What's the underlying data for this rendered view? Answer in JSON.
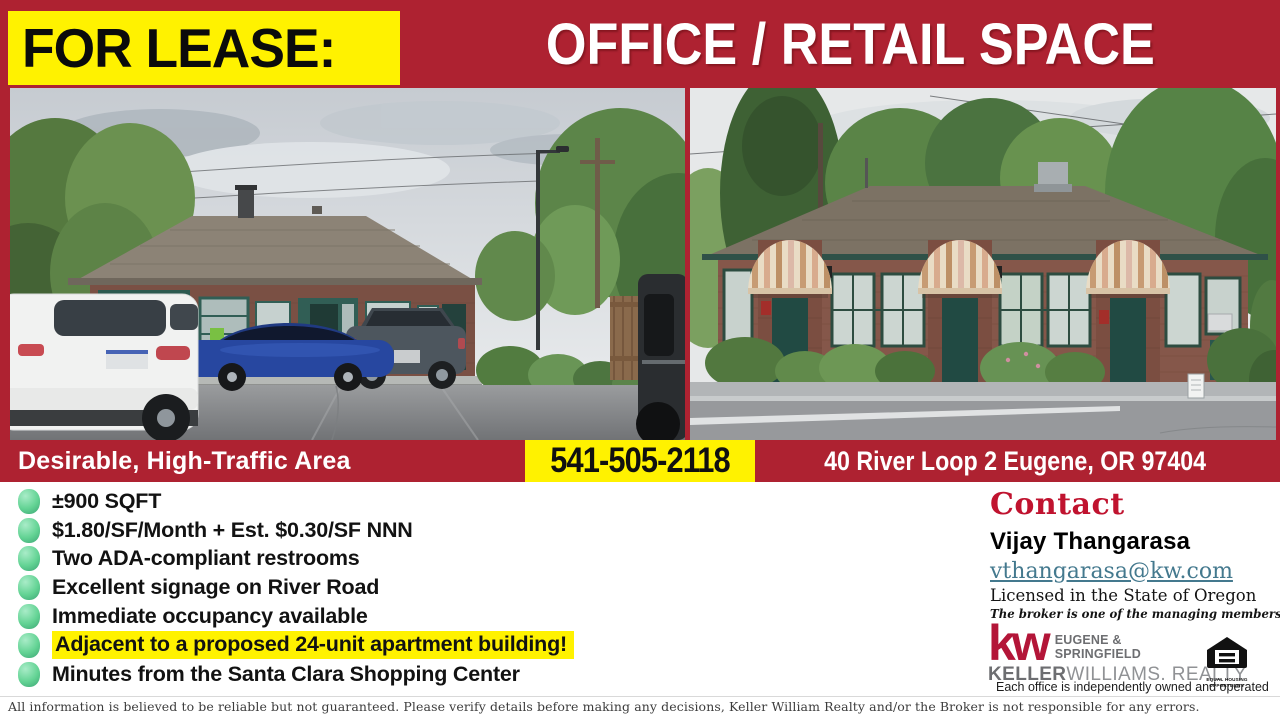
{
  "banner": {
    "for_lease_label": "FOR LEASE:",
    "title": "OFFICE / RETAIL SPACE"
  },
  "info_bar": {
    "tagline": "Desirable, High-Traffic Area",
    "phone": "541-505-2118",
    "address": "40 River Loop 2 Eugene, OR 97404"
  },
  "features": {
    "items": [
      {
        "text": "±900 SQFT",
        "highlighted": false
      },
      {
        "text": "$1.80/SF/Month + Est. $0.30/SF NNN",
        "highlighted": false
      },
      {
        "text": "Two ADA-compliant restrooms",
        "highlighted": false
      },
      {
        "text": "Excellent signage on River Road",
        "highlighted": false
      },
      {
        "text": "Immediate occupancy available",
        "highlighted": false
      },
      {
        "text": "Adjacent to a proposed 24-unit apartment building!",
        "highlighted": true
      },
      {
        "text": "Minutes from the Santa Clara Shopping Center",
        "highlighted": false
      }
    ]
  },
  "contact": {
    "heading": "Contact",
    "name": "Vijay Thangarasa",
    "email": "vthangarasa@kw.com",
    "license": "Licensed in the State of Oregon",
    "broker_note": "The broker is one of the managing members of the property",
    "office_note": "Each office is independently owned and operated"
  },
  "kw_logo": {
    "mark": "kw",
    "region_line1": "EUGENE &",
    "region_line2": "SPRINGFIELD",
    "brand_bold": "KELLER",
    "brand_rest": "WILLIAMS. REALTY"
  },
  "equal_housing": {
    "line1": "EQUAL HOUSING",
    "line2": "OPPORTUNITY"
  },
  "photos": {
    "left_sign": "FILLING STATION",
    "open_sign": "OPEN"
  },
  "footer": {
    "disclaimer": "All information is believed to be reliable but not guaranteed. Please verify details before making any decisions, Keller William Realty and/or the Broker is not responsible for any errors."
  },
  "colors": {
    "banner_red": "#AE2231",
    "highlight_yellow": "#FFF200",
    "bullet_green": "#63D394",
    "contact_red": "#C0132F",
    "email_teal": "#44798E",
    "kw_red": "#B31538"
  }
}
